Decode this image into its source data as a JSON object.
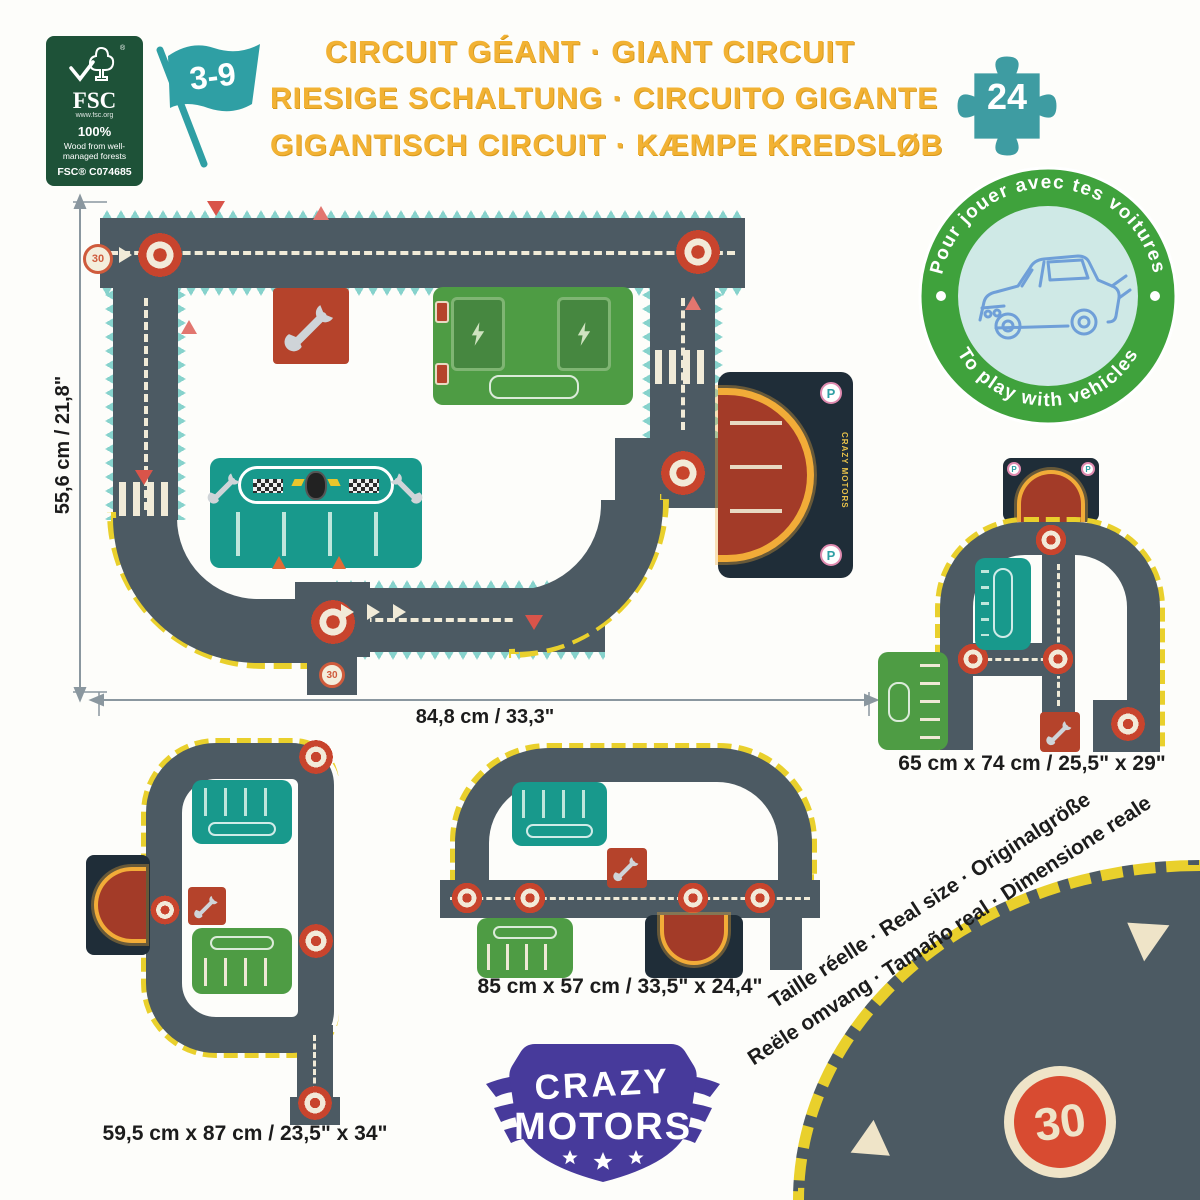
{
  "certification": {
    "fsc_title": "FSC",
    "fsc_url": "www.fsc.org",
    "fsc_percent": "100%",
    "fsc_desc": "Wood from well-managed forests",
    "fsc_code": "FSC® C074685"
  },
  "age_range": "3-9",
  "piece_count": "24",
  "title_lines": [
    "CIRCUIT GÉANT · GIANT CIRCUIT",
    "RIESIGE SCHALTUNG · CIRCUITO GIGANTE",
    "GIGANTISCH CIRCUIT · KÆMPE KREDSLØB"
  ],
  "play_badge": {
    "arc_top": "Pour jouer avec tes voitures",
    "arc_bottom": "To play with vehicles"
  },
  "dimensions": {
    "main_height": "55,6 cm / 21,8\"",
    "main_width": "84,8 cm / 33,3\"",
    "circuit_right": "65 cm x 74 cm / 25,5\" x 29\"",
    "circuit_bottom_middle": "85 cm x 57 cm / 33,5\" x 24,4\"",
    "circuit_bottom_left": "59,5 cm x 87 cm / 23,5\" x 34\""
  },
  "signs": {
    "speed_limit": "30",
    "parking": "P"
  },
  "brand": {
    "name_line1": "CRAZY",
    "name_line2": "MOTORS",
    "garage_label": "CRAZY MOTORS"
  },
  "real_size_note": {
    "line1": "Taille réelle · Real size · Originalgröße",
    "line2": "Reële omvang · Tamaño real · Dimensione reale"
  },
  "icons": {
    "fsc-tree-icon": "check+tree outline",
    "flag-icon": "waving teal flag",
    "puzzle-piece-icon": "teal jigsaw piece",
    "car-outline-icon": "blue line-drawn toy car",
    "wrench-icon": "grey wrench",
    "roundabout-icon": "red/white concentric circles",
    "speed-sign-icon": "circle 30 sign",
    "parking-sign-icon": "white circle with P",
    "warning-triangle-icon": "red/pink triangle",
    "crosswalk-icon": "cream zebra stripes",
    "traffic-cone-icon": "orange cone",
    "checkered-flag-icon": "black/white checker",
    "wheel-icon": "black tyre",
    "lightning-icon": "charging bolt",
    "star-icon": "white star",
    "wing-icon": "logo wing"
  },
  "colors": {
    "road": "#4C5A63",
    "track_edge_teal": "#86D2CC",
    "hazard_yellow": "#E9D02C",
    "board_teal": "#18998C",
    "board_green": "#4E9C44",
    "tile_red": "#B5432B",
    "garage_navy": "#1F2D38",
    "garage_red": "#A33B28",
    "glow_orange": "#F2AC38",
    "title_yellow": "#F2B233",
    "badge_green": "#3FA23C",
    "flag_teal": "#2F9FA4",
    "brand_purple": "#473A9B",
    "fsc_green": "#1E5238",
    "cream": "#F1EBD8"
  }
}
